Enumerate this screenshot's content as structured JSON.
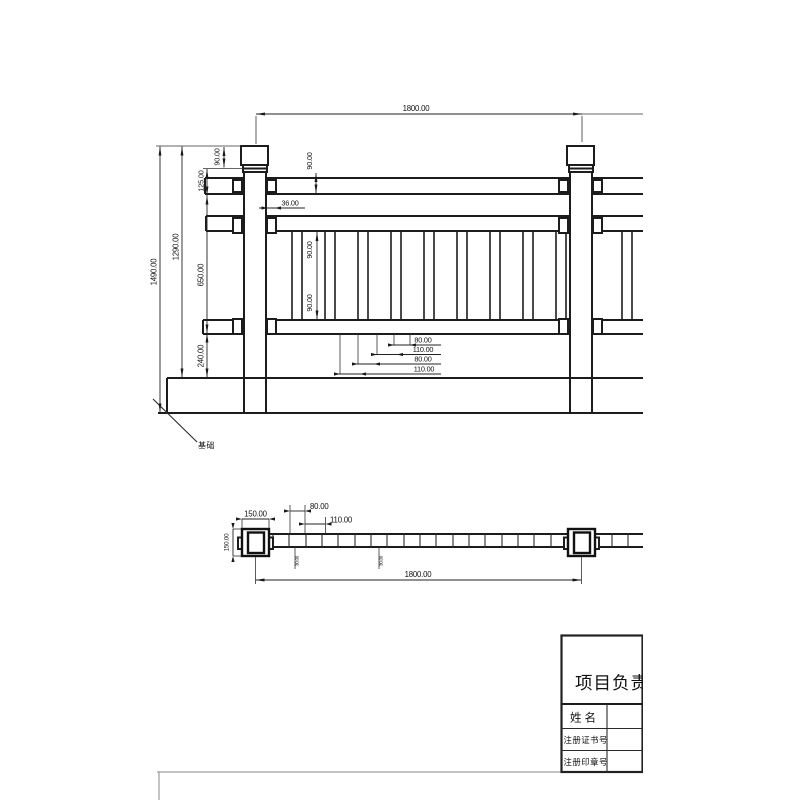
{
  "drawing_title": "railing-shop-drawing",
  "elevation": {
    "dim_span_top": "1800.00",
    "dim_total_height": "1490.00",
    "dim_upper_height": "1290.00",
    "dim_cap": "90.00",
    "dim_handrail": "90.00",
    "dim_cap_to_rail": "125.00",
    "dim_panel": "650.00",
    "dim_base": "240.00",
    "dim_panel_upper": "90.00",
    "dim_panel_lower": "90.00",
    "dim_offset": "36.00",
    "dim_b_gap1": "80.00",
    "dim_b_pitch1": "110.00",
    "dim_b_gap2": "80.00",
    "dim_b_pitch2": "110.00",
    "leader_label": "基础"
  },
  "plan": {
    "dim_post_w": "150.00",
    "dim_post_d": "150.00",
    "dim_gap": "80.00",
    "dim_pitch": "110.00",
    "dim_bal1": "30.00",
    "dim_bal2": "30.00",
    "dim_span": "1800.00"
  },
  "title_block": {
    "header": "项目负责人",
    "rows": [
      {
        "label": "姓名",
        "value": ""
      },
      {
        "label": "注册证书号",
        "value": ""
      },
      {
        "label": "注册印章号",
        "value": ""
      }
    ]
  },
  "colors": {
    "line": "#1c1c1c",
    "background": "#ffffff"
  }
}
